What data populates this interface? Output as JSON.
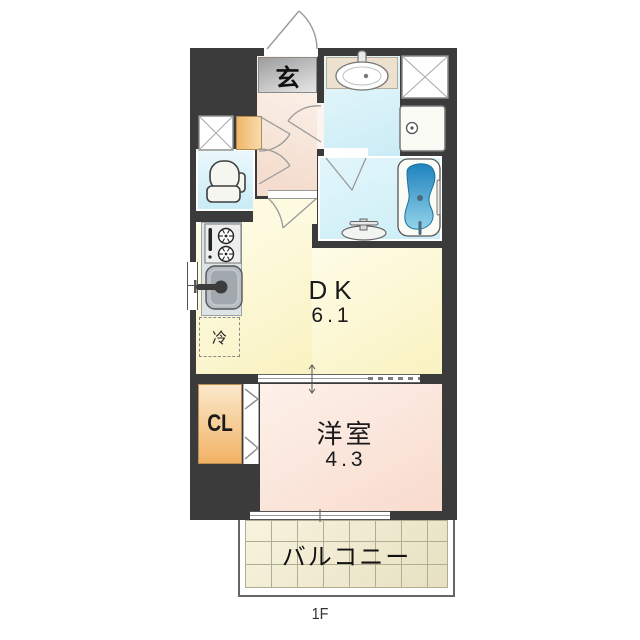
{
  "floor_plan": {
    "floor_label": "1F",
    "rooms": {
      "entrance": {
        "label": "玄"
      },
      "dining_kitchen": {
        "label": "DK",
        "size": "6.1"
      },
      "western_room": {
        "label": "洋室",
        "size": "4.3"
      },
      "closet": {
        "label": "CL"
      },
      "refrigerator_space": {
        "label": "冷"
      },
      "balcony": {
        "label": "バルコニー"
      }
    },
    "fixtures": {
      "entrance_door": "outward swing door",
      "washbasin": "vanity basin",
      "washing_machine_pan": "washer pan with drain",
      "pipe_shaft": "x-crossed shaft box",
      "meter_box": "x-crossed meter box",
      "shoe_cabinet": "shoe cabinet",
      "toilet": "toilet",
      "bathtub": "bathtub",
      "bath_faucet": "bath faucet",
      "stove": "two-burner stove with grill",
      "kitchen_sink": "kitchen sink with faucet",
      "closet_door": "bi-fold door",
      "dk_partition": "sliding door with pocket track",
      "windows": "kitchen window, balcony window"
    },
    "colors": {
      "wall": "#3b3b3b",
      "dk_floor": "#f9f2c0",
      "western_room_floor": "#f8dbcd",
      "hallway_floor": "#f4ddce",
      "wet_area_floor": "#cdeef7",
      "closet": "#f2b266",
      "balcony_tile": "#e7e1c2",
      "bathtub_water": "#3391c4",
      "entrance_mat": "#bdbdbd"
    }
  }
}
